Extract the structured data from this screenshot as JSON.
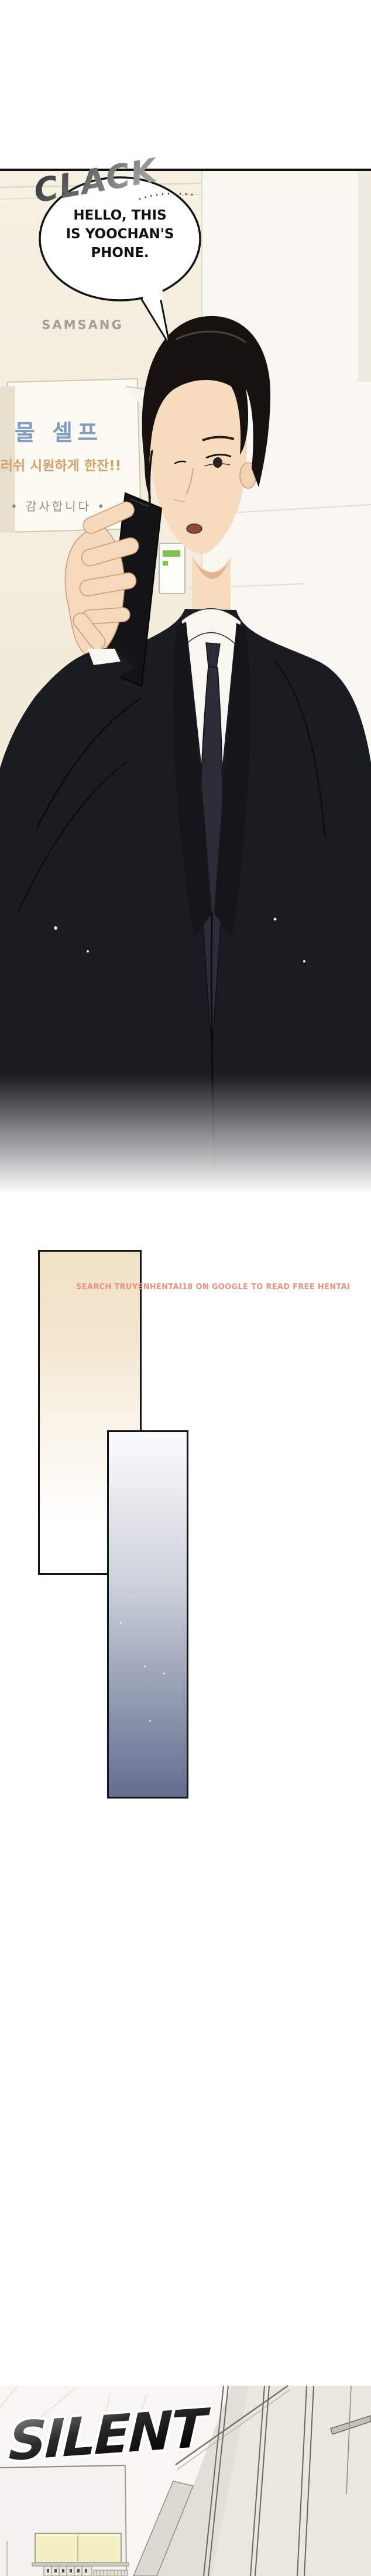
{
  "panel1": {
    "sfx": "CLACK",
    "bubble": {
      "line1": "HELLO, THIS",
      "line2": "IS YOOCHAN'S",
      "line3": "PHONE."
    },
    "machine_brand": "SAMSANG",
    "sign": {
      "title_kr": "물 셀프",
      "promo_kr": "러쉬 시원하게 한잔!!",
      "thanks_kr": "• 감사합니다 •"
    }
  },
  "watermark": {
    "text": "SEARCH TRUYENHENTAI18 ON GOOGLE TO READ FREE HENTAI",
    "color": "#F09180"
  },
  "transition_panels": {
    "beige_top_color": "#F0E1C5",
    "beige_bottom_color": "#FFFFFF",
    "blue_top_color": "#FAFBFC",
    "blue_bottom_color": "#636E90",
    "border_color": "#151515"
  },
  "panel2": {
    "sfx": "SILENT"
  },
  "art_colors": {
    "suit": "#1B1C21",
    "skin": "#F7DBBE",
    "hair": "#17120F",
    "tie": "#2A2C38",
    "shirt": "#F8F6F0",
    "phone": "#141416",
    "machine_cream": "#F5EEDF",
    "sign_blue": "#7C9CC4",
    "sign_orange": "#D99F68",
    "sign_gray": "#8E8A80",
    "brand_gray": "#A49E92",
    "green_indicator": "#7CC350",
    "sfx_dark": "#1A1A1A"
  }
}
